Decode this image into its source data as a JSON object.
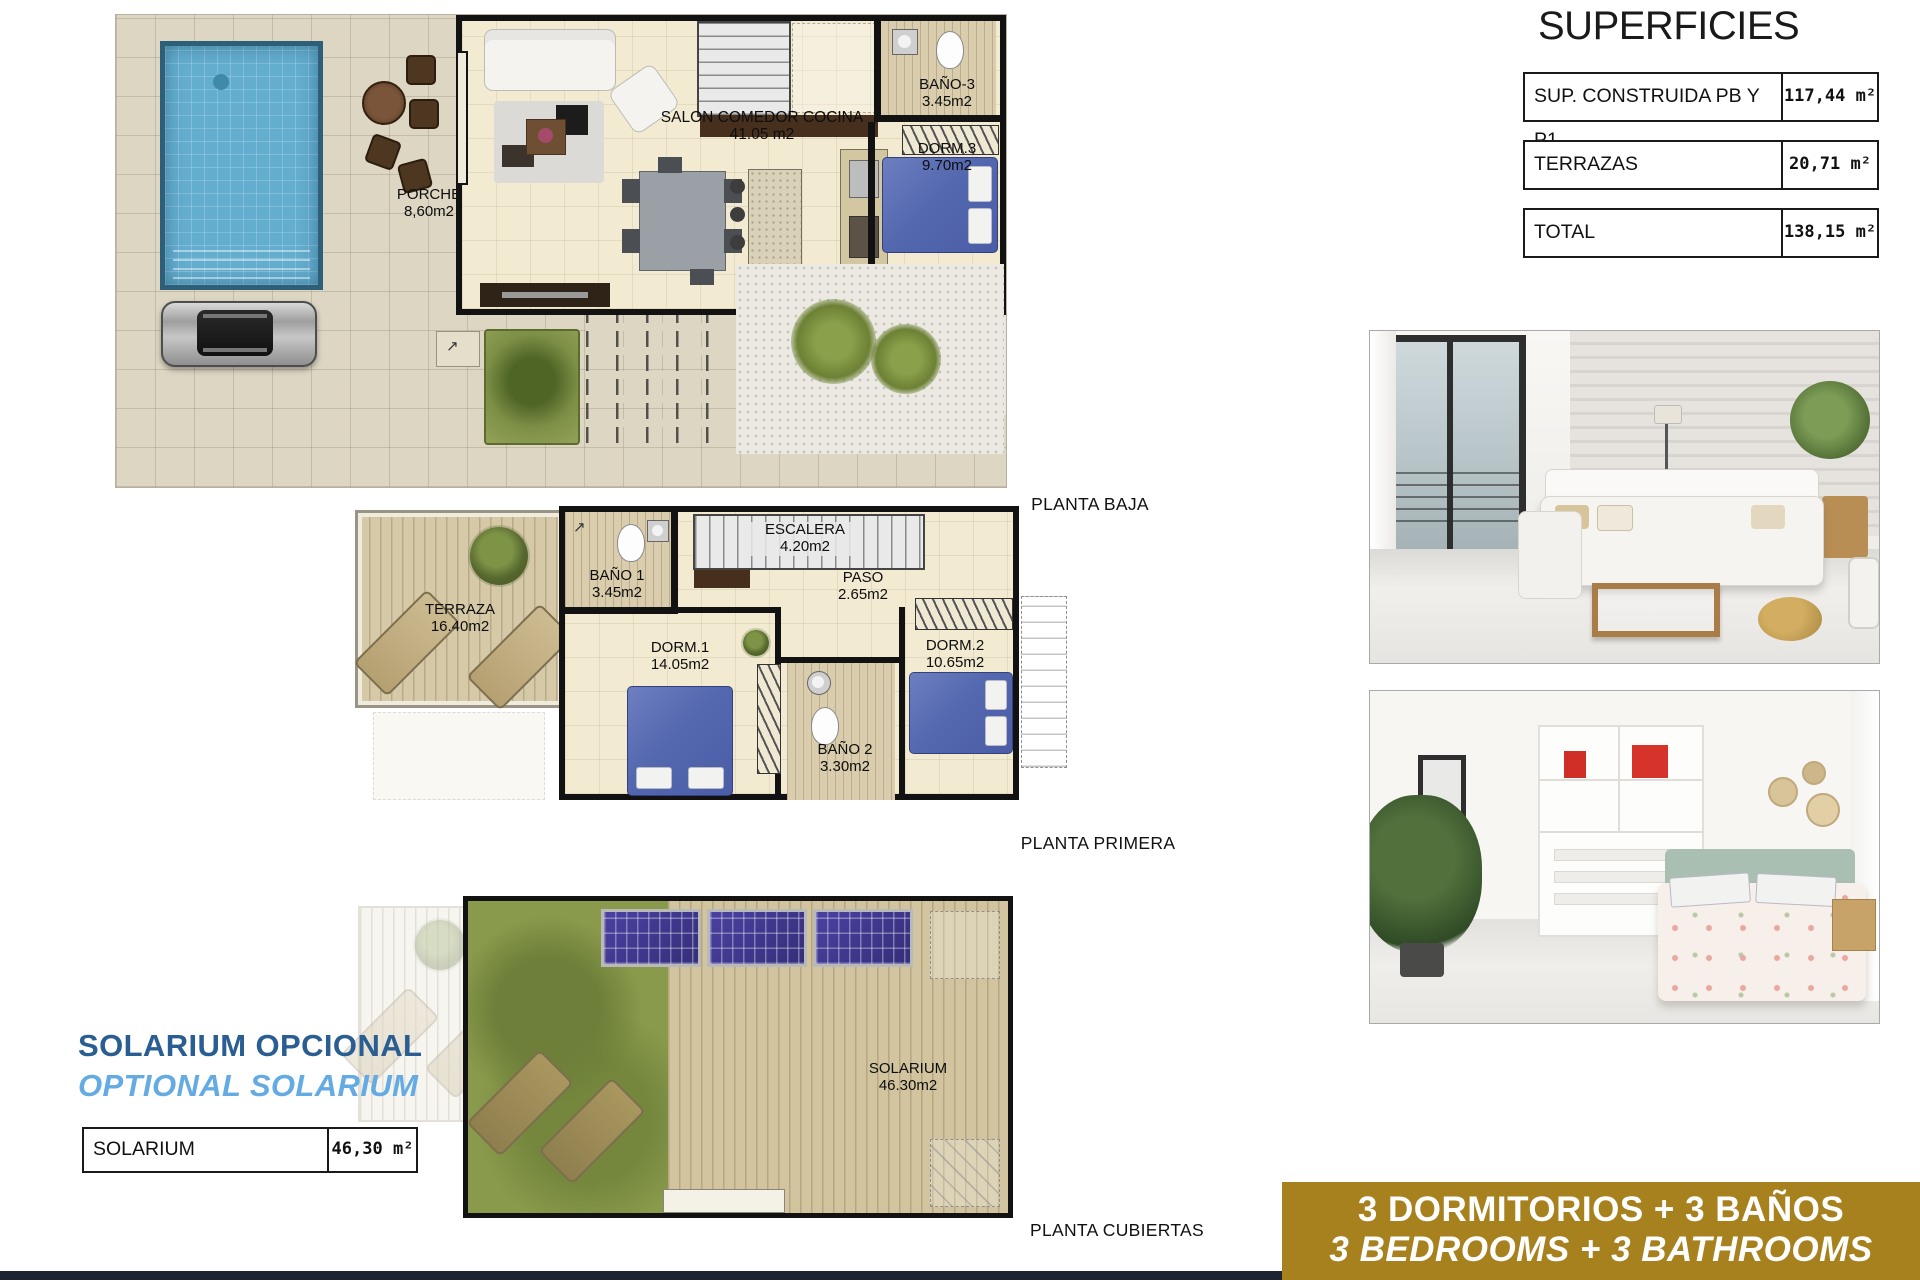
{
  "superficies": {
    "title": "SUPERFICIES",
    "rows": [
      {
        "label": "SUP. CONSTRUIDA PB Y P1",
        "value": "117,44 m²"
      },
      {
        "label": "TERRAZAS",
        "value": "20,71 m²"
      },
      {
        "label": "TOTAL",
        "value": "138,15 m²"
      }
    ]
  },
  "plans": {
    "baja": {
      "caption": "PLANTA BAJA",
      "rooms": {
        "porche": {
          "name": "PORCHE",
          "area": "8,60m2"
        },
        "salon": {
          "name": "SALON COMEDOR COCINA",
          "area": "41.05 m2"
        },
        "bano3": {
          "name": "BAÑO-3",
          "area": "3.45m2"
        },
        "dorm3": {
          "name": "DORM.3",
          "area": "9.70m2"
        }
      }
    },
    "primera": {
      "caption": "PLANTA PRIMERA",
      "rooms": {
        "terraza": {
          "name": "TERRAZA",
          "area": "16.40m2"
        },
        "bano1": {
          "name": "BAÑO 1",
          "area": "3.45m2"
        },
        "escalera": {
          "name": "ESCALERA",
          "area": "4.20m2"
        },
        "paso": {
          "name": "PASO",
          "area": "2.65m2"
        },
        "dorm1": {
          "name": "DORM.1",
          "area": "14.05m2"
        },
        "dorm2": {
          "name": "DORM.2",
          "area": "10.65m2"
        },
        "bano2": {
          "name": "BAÑO 2",
          "area": "3.30m2"
        }
      }
    },
    "cubiertas": {
      "caption": "PLANTA CUBIERTAS",
      "rooms": {
        "solarium": {
          "name": "SOLARIUM",
          "area": "46.30m2"
        }
      }
    }
  },
  "solarium_block": {
    "title_es": "SOLARIUM OPCIONAL",
    "title_en": "OPTIONAL SOLARIUM",
    "table": {
      "label": "SOLARIUM",
      "value": "46,30 m²"
    }
  },
  "banner": {
    "line_es": "3 DORMITORIOS + 3 BAÑOS",
    "line_en": "3 BEDROOMS + 3 BATHROOMS"
  },
  "colors": {
    "accent_dark_blue": "#2a5e93",
    "accent_light_blue": "#64abe4",
    "banner_gold": "#a8811f",
    "banner_text": "#ffffff",
    "footer_strip_navy": "#1c2331",
    "pool_blue": "#63adcf",
    "grass_green": "#8a9a4c",
    "bed_blue": "#5468b0",
    "solar_panel_purple": "#3c3488"
  }
}
